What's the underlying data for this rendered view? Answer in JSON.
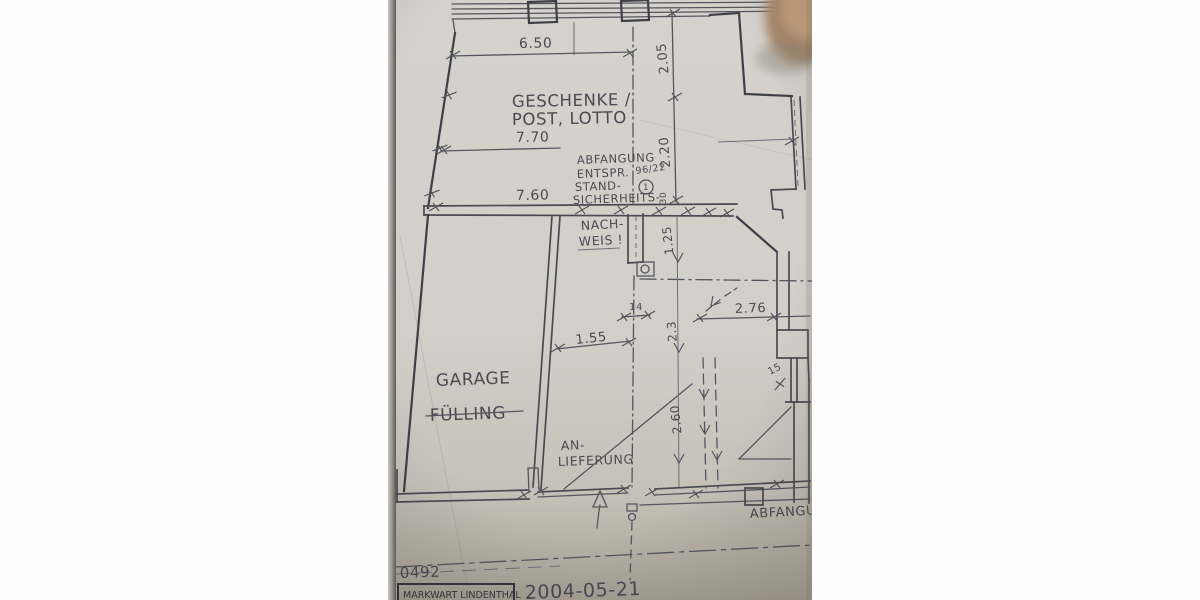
{
  "photo": {
    "colors": {
      "paper": "#d3d0cb",
      "pencil": "#55555d",
      "ink": "#35353b",
      "thumb": "#b3916f"
    },
    "rooms": {
      "retail_line1": "GESCHENKE /",
      "retail_line2": "POST, LOTTO",
      "garage_line1": "GARAGE",
      "garage_line2": "FÜLLING",
      "delivery_line1": "AN-",
      "delivery_line2": "LIEFERUNG"
    },
    "note": {
      "l1": "ABFANGUNG",
      "l2": "ENTSPR.",
      "l3": "STAND-",
      "l4": "SICHERHEITS-",
      "l5": "NACH-",
      "l6": "WEIS !",
      "ref": "96/22",
      "marker": "1"
    },
    "dims": {
      "d650": "6.50",
      "d770": "7.70",
      "d760": "7.60",
      "d205": "2.05",
      "d220": "2.20",
      "d30": "30",
      "d125": "1.25",
      "d14": "14",
      "d23": "2.3",
      "d276": "2.76",
      "d155": "1.55",
      "d15": "15",
      "d260": "2.60"
    },
    "edge_note": "ABFANGU",
    "titleblock": {
      "number": "0492",
      "firm": "MARKWART LINDENTHAL",
      "date": "2004-05-21"
    }
  }
}
